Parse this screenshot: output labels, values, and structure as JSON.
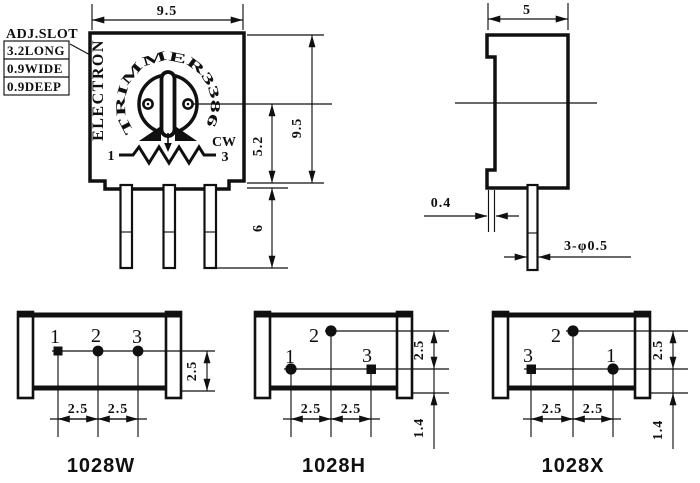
{
  "front": {
    "callout": {
      "title": "ADJ.SLOT",
      "row1": "3.2LONG",
      "row2": "0.9WIDE",
      "row3": "0.9DEEP"
    },
    "brand": "ELECTRON",
    "arc_text": "TRIMMER3386",
    "pin_left": "1",
    "pin_right": "3",
    "cw": "CW",
    "dim_width": "9.5",
    "dim_height": "9.5",
    "dim_center_to_base": "5.2",
    "dim_pin_length": "6"
  },
  "side": {
    "dim_width": "5",
    "dim_cover": "0.4",
    "dim_pin_dia": "3-φ0.5"
  },
  "footprints": [
    {
      "model": "1028W",
      "pin_a": "1",
      "pin_b": "2",
      "pin_c": "3",
      "pitch_ab": "2.5",
      "pitch_bc": "2.5",
      "row_height": "2.5"
    },
    {
      "model": "1028H",
      "pin_a": "1",
      "pin_b": "2",
      "pin_c": "3",
      "pitch_ab": "2.5",
      "pitch_bc": "2.5",
      "row_gap": "2.5",
      "base_gap": "1.4"
    },
    {
      "model": "1028X",
      "pin_a": "3",
      "pin_b": "2",
      "pin_c": "1",
      "pitch_ab": "2.5",
      "pitch_bc": "2.5",
      "row_gap": "2.5",
      "base_gap": "1.4"
    }
  ]
}
